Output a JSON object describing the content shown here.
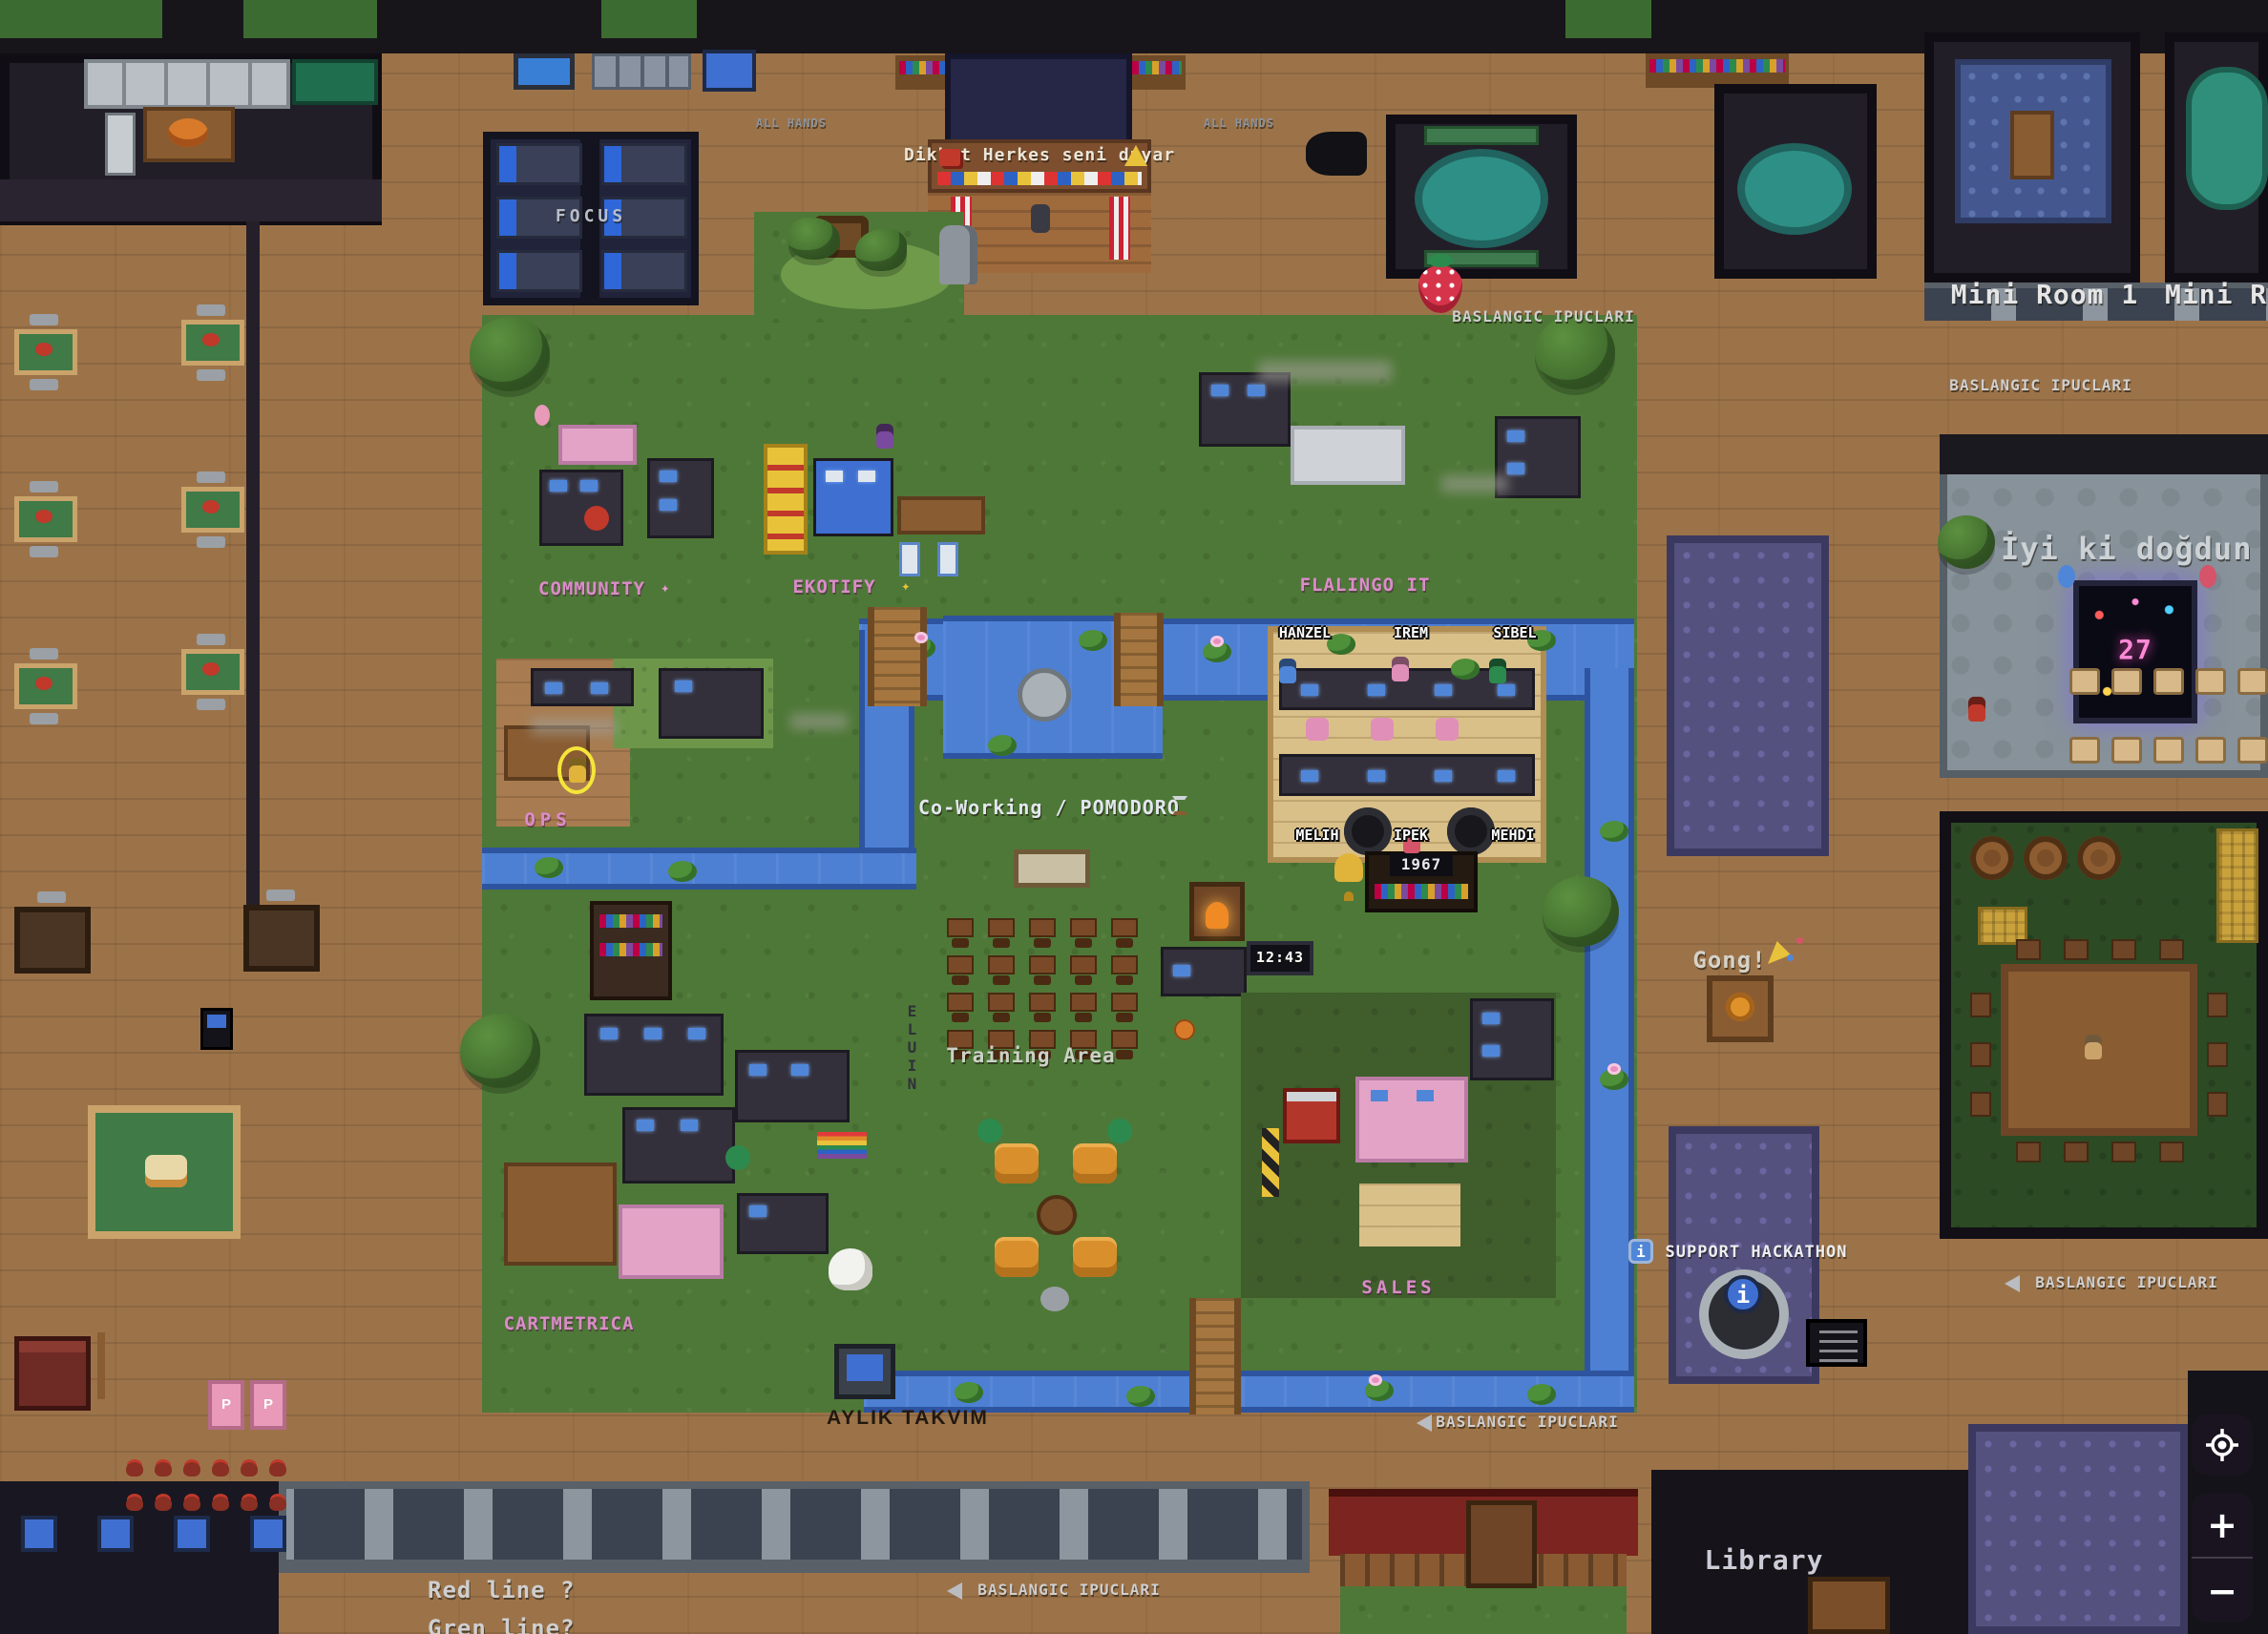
{
  "labels": {
    "focus": "FOCUS",
    "all_hands": "ALL HANDS",
    "banner": "Dikkat Herkes seni duyar",
    "tips": "BASLANGIC IPUCLARI",
    "mini_room_1": "Mini Room 1",
    "mini_room_2": "Mini Ro",
    "birthday": "İyi ki doğdun Esma",
    "community": "COMMUNITY",
    "ekotify": "EKOTIFY",
    "flalingo_it": "FLALINGO IT",
    "coworking": "Co-Working / POMODORO",
    "ops": "OPS",
    "training_area": "Training Area",
    "cartmetrica": "CARTMETRICA",
    "sales": "SALES",
    "gong": "Gong!",
    "support_hackathon": "SUPPORT HACKATHON",
    "aylik_takvim": "AYLIK TAKVIM",
    "library": "Library",
    "red_line": "Red line ?",
    "green_line": "Gren line?",
    "eluin": "ELUIN",
    "neon_number": "27",
    "shelf_year": "1967",
    "scoreboard": "12:43",
    "parking": "P",
    "info_letter": "i"
  },
  "players": [
    "HANZEL",
    "IREM",
    "SIBEL",
    "MELIH",
    "IPEK",
    "MEHDI"
  ],
  "controls": {
    "locate_icon": "crosshair",
    "zoom_in": "+",
    "zoom_out": "−"
  },
  "icons": {
    "sparkle": "✦",
    "warning": "⚠",
    "megaphone": "📢",
    "party_popper": "🎉",
    "hourglass": "⌛",
    "arrow_left": "◄"
  },
  "colors": {
    "accent_pink": "#db8cc9",
    "water": "#4d80d3",
    "grass": "#4e7837",
    "wood": "#9c7349",
    "dark_room": "#1b1820",
    "rug_purple": "#55517e",
    "teal": "#2e8f86",
    "label_light": "#d6d6d6",
    "highlight_ring": "#f5e53a"
  }
}
